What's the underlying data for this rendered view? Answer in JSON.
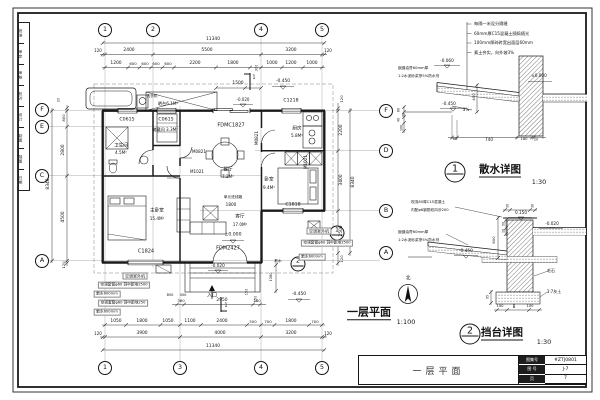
{
  "sheet": {
    "signature_strip": {
      "cells": [
        "批准",
        "审定",
        "审核",
        "校对",
        "设计",
        "制图",
        "描图",
        "日期"
      ]
    },
    "title_block": {
      "drawing_title": "一层平面",
      "fields": [
        {
          "label": "图集号",
          "value": "#ZTJ0801"
        },
        {
          "label": "图 号",
          "value": "J-7"
        },
        {
          "label": "页",
          "value": "7"
        }
      ]
    }
  },
  "plan": {
    "title": "一层平面",
    "scale": "1:100",
    "north_label": "北",
    "overall_dimensions": {
      "width": "11340",
      "height": "8340"
    },
    "grid_axes": {
      "horizontal": [
        "1",
        "2",
        "3",
        "4",
        "5"
      ],
      "vertical": [
        "A",
        "B",
        "C",
        "D",
        "E",
        "F"
      ]
    },
    "rooms": [
      {
        "name": "卫生间",
        "area": "4.5M²"
      },
      {
        "name": "储藏间",
        "area": "3.3M²"
      },
      {
        "name": "餐厅",
        "area": "7.2M²"
      },
      {
        "name": "厨房",
        "area": "5.8M²"
      },
      {
        "name": "主卧室",
        "area": "15.4M²"
      },
      {
        "name": "客厅",
        "area": "17.0M²"
      },
      {
        "name": "卧室",
        "area": "9.4M²"
      },
      {
        "name": "晒台",
        "area": "6.1M²"
      }
    ],
    "openings": [
      "C0615",
      "C1218",
      "C1818",
      "C1824",
      "FDMC1827",
      "FDM2427",
      "M0821",
      "M1021"
    ],
    "levels": [
      "±0.000",
      "-0.020",
      "-0.450"
    ]
  },
  "details": [
    {
      "number": "1",
      "title": "散水详图",
      "scale": "1:30"
    },
    {
      "number": "2",
      "title": "挡台详图",
      "scale": "1:30"
    }
  ],
  "bubbles": [
    {
      "x": 105,
      "y": 30,
      "t": "1",
      "k": "g"
    },
    {
      "x": 153,
      "y": 30,
      "t": "2",
      "k": "g"
    },
    {
      "x": 261,
      "y": 30,
      "t": "4",
      "k": "g"
    },
    {
      "x": 322,
      "y": 30,
      "t": "5",
      "k": "g"
    },
    {
      "x": 105,
      "y": 368,
      "t": "1",
      "k": "g"
    },
    {
      "x": 180,
      "y": 368,
      "t": "3",
      "k": "g"
    },
    {
      "x": 261,
      "y": 368,
      "t": "4",
      "k": "g"
    },
    {
      "x": 322,
      "y": 368,
      "t": "5",
      "k": "g"
    },
    {
      "x": 42,
      "y": 110,
      "t": "F",
      "k": "g"
    },
    {
      "x": 42,
      "y": 127,
      "t": "E",
      "k": "g"
    },
    {
      "x": 42,
      "y": 176,
      "t": "C",
      "k": "g"
    },
    {
      "x": 42,
      "y": 261,
      "t": "A",
      "k": "g"
    },
    {
      "x": 386,
      "y": 111,
      "t": "F",
      "k": "g"
    },
    {
      "x": 386,
      "y": 151,
      "t": "D",
      "k": "g"
    },
    {
      "x": 386,
      "y": 211,
      "t": "B",
      "k": "g"
    },
    {
      "x": 386,
      "y": 253,
      "t": "A",
      "k": "g"
    },
    {
      "x": 337,
      "y": 233,
      "t": "1",
      "k": "s"
    },
    {
      "x": 298,
      "y": 264,
      "t": "2",
      "k": "s"
    },
    {
      "x": 455,
      "y": 172,
      "t": "1",
      "k": "d"
    },
    {
      "x": 470,
      "y": 334,
      "t": "2",
      "k": "d"
    }
  ],
  "labels": [
    {
      "t": "11340",
      "x": 213,
      "y": 40
    },
    {
      "t": "120",
      "x": 98,
      "y": 51,
      "s": 4
    },
    {
      "t": "2400",
      "x": 129,
      "y": 51
    },
    {
      "t": "5500",
      "x": 207,
      "y": 51
    },
    {
      "t": "3200",
      "x": 291,
      "y": 51
    },
    {
      "t": "120",
      "x": 328,
      "y": 51,
      "s": 4
    },
    {
      "t": "1200",
      "x": 116,
      "y": 64
    },
    {
      "t": "600",
      "x": 133,
      "y": 64,
      "s": 3.8
    },
    {
      "t": "600",
      "x": 145,
      "y": 64,
      "s": 3.8
    },
    {
      "t": "600",
      "x": 156,
      "y": 64,
      "s": 3.8
    },
    {
      "t": "600",
      "x": 168,
      "y": 64,
      "s": 3.8
    },
    {
      "t": "2200",
      "x": 195,
      "y": 64
    },
    {
      "t": "1800",
      "x": 233,
      "y": 64
    },
    {
      "t": "300",
      "x": 257,
      "y": 68,
      "s": 3.4,
      "r": -90
    },
    {
      "t": "1000",
      "x": 272,
      "y": 64
    },
    {
      "t": "1200",
      "x": 291,
      "y": 64
    },
    {
      "t": "1000",
      "x": 312,
      "y": 64
    },
    {
      "t": "1500",
      "x": 238,
      "y": 84
    },
    {
      "t": "-0.450",
      "x": 283,
      "y": 82,
      "c": "v"
    },
    {
      "t": "-0.020",
      "x": 243,
      "y": 100,
      "s": 4,
      "c": "v"
    },
    {
      "t": "1",
      "x": 254,
      "y": 78,
      "s": 5
    },
    {
      "t": "8340",
      "x": 49,
      "y": 184,
      "r": -90
    },
    {
      "t": "20",
      "x": 59,
      "y": 100,
      "r": -90,
      "s": 3.4
    },
    {
      "t": "800",
      "x": 64,
      "y": 118,
      "r": -90,
      "s": 3.8
    },
    {
      "t": "2800",
      "x": 64,
      "y": 150,
      "r": -90
    },
    {
      "t": "4500",
      "x": 64,
      "y": 217,
      "r": -90
    },
    {
      "t": "120",
      "x": 64,
      "y": 265,
      "r": -90,
      "s": 3.8
    },
    {
      "t": "8340",
      "x": 354,
      "y": 182,
      "r": -90
    },
    {
      "t": "120",
      "x": 342,
      "y": 99,
      "r": -90,
      "s": 3.8
    },
    {
      "t": "2200",
      "x": 342,
      "y": 130,
      "r": -90
    },
    {
      "t": "3400",
      "x": 342,
      "y": 180,
      "r": -90
    },
    {
      "t": "2500",
      "x": 342,
      "y": 231,
      "r": -90
    },
    {
      "t": "120",
      "x": 342,
      "y": 259,
      "r": -90,
      "s": 3.8
    },
    {
      "t": "360",
      "x": 181,
      "y": 301,
      "s": 3.8
    },
    {
      "t": "2950",
      "x": 222,
      "y": 301
    },
    {
      "t": "360",
      "x": 257,
      "y": 301,
      "s": 3.8
    },
    {
      "t": "150",
      "x": 247,
      "y": 292,
      "s": 3.4,
      "r": -90
    },
    {
      "t": "150",
      "x": 256,
      "y": 299,
      "s": 3.4,
      "r": -90
    },
    {
      "t": "1050",
      "x": 116,
      "y": 322
    },
    {
      "t": "1800",
      "x": 142,
      "y": 322
    },
    {
      "t": "1050",
      "x": 168,
      "y": 322
    },
    {
      "t": "1100",
      "x": 190,
      "y": 322
    },
    {
      "t": "2400",
      "x": 222,
      "y": 322
    },
    {
      "t": "500",
      "x": 253,
      "y": 322,
      "s": 3.8
    },
    {
      "t": "700",
      "x": 268,
      "y": 322,
      "s": 3.8
    },
    {
      "t": "1800",
      "x": 291,
      "y": 322
    },
    {
      "t": "700",
      "x": 315,
      "y": 322,
      "s": 3.8
    },
    {
      "t": "120",
      "x": 98,
      "y": 334,
      "s": 4
    },
    {
      "t": "3900",
      "x": 142,
      "y": 334
    },
    {
      "t": "4000",
      "x": 220,
      "y": 334
    },
    {
      "t": "3200",
      "x": 291,
      "y": 334
    },
    {
      "t": "120",
      "x": 328,
      "y": 334,
      "s": 4
    },
    {
      "t": "11340",
      "x": 213,
      "y": 347
    },
    {
      "t": "1",
      "x": 226,
      "y": 306,
      "s": 5
    },
    {
      "t": "入口",
      "x": 212,
      "y": 296,
      "s": 5,
      "c": "n"
    },
    {
      "t": "-0.450",
      "x": 299,
      "y": 295,
      "c": "v"
    },
    {
      "t": "850",
      "x": 170,
      "y": 296,
      "s": 3.6
    },
    {
      "t": "450",
      "x": 183,
      "y": 296,
      "s": 3.6
    },
    {
      "t": "1360",
      "x": 272,
      "y": 277,
      "r": -90,
      "s": 3.6
    },
    {
      "t": "空调室外机",
      "x": 135,
      "y": 276,
      "s": 4,
      "bg": 1,
      "c": "n"
    },
    {
      "t": "空调套管φ60 洞中距地2500",
      "x": 124,
      "y": 285,
      "s": 3.7,
      "bg": 1,
      "c": "n"
    },
    {
      "t": "散水600mm",
      "x": 107,
      "y": 294,
      "s": 3.7,
      "bg": 1,
      "c": "n"
    },
    {
      "t": "空调套管φ60 洞中距地250",
      "x": 123,
      "y": 303,
      "s": 3.7,
      "bg": 1,
      "c": "n"
    },
    {
      "t": "散水600mm",
      "x": 107,
      "y": 312,
      "s": 3.7,
      "bg": 1,
      "c": "n"
    },
    {
      "t": "空调室外机",
      "x": 319,
      "y": 231,
      "s": 4,
      "bg": 1,
      "c": "n"
    },
    {
      "t": "空调套管φ60 洞中距地2500",
      "x": 327,
      "y": 243,
      "s": 3.7,
      "bg": 1,
      "c": "n"
    },
    {
      "t": "散水600mm",
      "x": 312,
      "y": 257,
      "s": 3.7,
      "bg": 1,
      "c": "n"
    },
    {
      "t": "散水",
      "x": 278,
      "y": 262,
      "s": 3.7,
      "c": "n"
    },
    {
      "t": "卫生间",
      "x": 121,
      "y": 147,
      "s": 4.6,
      "c": "r"
    },
    {
      "t": "4.5M²",
      "x": 121,
      "y": 153,
      "s": 4.2,
      "c": "r"
    },
    {
      "t": "储藏间 3.3M²",
      "x": 165,
      "y": 130,
      "s": 4.2,
      "c": "r"
    },
    {
      "t": "餐厅",
      "x": 228,
      "y": 171,
      "s": 4.6,
      "c": "r"
    },
    {
      "t": "7.2M²",
      "x": 228,
      "y": 177,
      "s": 4.2,
      "c": "r"
    },
    {
      "t": "厨房",
      "x": 297,
      "y": 130,
      "s": 4.6,
      "c": "r"
    },
    {
      "t": "5.8M²",
      "x": 297,
      "y": 136,
      "s": 4.2,
      "c": "r"
    },
    {
      "t": "主卧室",
      "x": 157,
      "y": 212,
      "s": 4.6,
      "c": "r"
    },
    {
      "t": "15.4M²",
      "x": 157,
      "y": 219,
      "s": 4.2,
      "c": "r"
    },
    {
      "t": "客厅",
      "x": 240,
      "y": 218,
      "s": 4.6,
      "c": "r"
    },
    {
      "t": "17.0M²",
      "x": 240,
      "y": 225,
      "s": 4.2,
      "c": "r"
    },
    {
      "t": "卧室",
      "x": 269,
      "y": 181,
      "s": 4.6,
      "c": "r"
    },
    {
      "t": "9.4M²",
      "x": 269,
      "y": 188,
      "s": 4.2,
      "c": "r"
    },
    {
      "t": "晒台6.1M²",
      "x": 168,
      "y": 104,
      "s": 4.2,
      "c": "r"
    },
    {
      "t": "洗衣机",
      "x": 152,
      "y": 97,
      "s": 3.7,
      "c": "n"
    },
    {
      "t": "C0615",
      "x": 127,
      "y": 121,
      "s": 4.7,
      "c": "o"
    },
    {
      "t": "C0615",
      "x": 166,
      "y": 121,
      "s": 4.7,
      "c": "o"
    },
    {
      "t": "FDMC1827",
      "x": 231,
      "y": 126,
      "s": 5,
      "c": "o"
    },
    {
      "t": "C1218",
      "x": 291,
      "y": 102,
      "s": 4.7,
      "c": "o"
    },
    {
      "t": "C1824",
      "x": 146,
      "y": 252,
      "s": 5,
      "c": "o"
    },
    {
      "t": "FDM2427",
      "x": 228,
      "y": 249,
      "s": 5,
      "c": "o"
    },
    {
      "t": "C1818",
      "x": 293,
      "y": 206,
      "s": 4.7,
      "c": "o"
    },
    {
      "t": "M0821",
      "x": 199,
      "y": 152,
      "s": 4.1,
      "c": "o"
    },
    {
      "t": "M1021",
      "x": 197,
      "y": 172,
      "s": 4.1,
      "c": "o"
    },
    {
      "t": "M1021",
      "x": 306,
      "y": 162,
      "r": -90,
      "s": 4.1,
      "c": "o"
    },
    {
      "t": "M0821",
      "x": 257,
      "y": 138,
      "r": -90,
      "s": 4.1,
      "c": "o"
    },
    {
      "t": "±0.000",
      "x": 233,
      "y": 236,
      "s": 4.6,
      "c": "v"
    },
    {
      "t": "-0.020",
      "x": 218,
      "y": 266,
      "s": 4.2,
      "c": "v"
    },
    {
      "t": "单元进线箱",
      "x": 233,
      "y": 198,
      "s": 3.7,
      "c": "n"
    },
    {
      "t": "1800",
      "x": 231,
      "y": 205,
      "s": 4.2
    },
    {
      "t": "一层平面",
      "x": 369,
      "y": 313,
      "s": 11,
      "w": 1,
      "u": 1,
      "c": "t"
    },
    {
      "t": "1:100",
      "x": 406,
      "y": 322,
      "s": 6.5,
      "c": "t"
    },
    {
      "t": "北",
      "x": 408,
      "y": 279,
      "s": 5,
      "c": "t"
    },
    {
      "t": "每隔一米设分隔缝",
      "x": 474,
      "y": 24,
      "s": 4.2,
      "a": "l",
      "c": "n"
    },
    {
      "t": "60mm厚C15混凝土随捣随光",
      "x": 474,
      "y": 33.5,
      "s": 4.2,
      "a": "l",
      "c": "n"
    },
    {
      "t": "100mm厚碎砖宽出面层60mm",
      "x": 474,
      "y": 43,
      "s": 4.2,
      "a": "l",
      "c": "n"
    },
    {
      "t": "素土夯实，向外坡3%",
      "x": 474,
      "y": 52.5,
      "s": 4.2,
      "a": "l",
      "c": "n"
    },
    {
      "t": "嵌缝油膏60mm厚",
      "x": 398,
      "y": 69,
      "s": 3.7,
      "a": "l",
      "c": "n"
    },
    {
      "t": "1:2水泥砂浆掺5%防水剂",
      "x": 398,
      "y": 77,
      "s": 3.7,
      "a": "l",
      "c": "n"
    },
    {
      "t": "-0.060",
      "x": 447,
      "y": 61,
      "s": 4.2,
      "c": "v"
    },
    {
      "t": "±0.000",
      "x": 539,
      "y": 76,
      "s": 4.2,
      "c": "v"
    },
    {
      "t": "-0.450",
      "x": 449,
      "y": 104,
      "s": 4.2,
      "c": "v"
    },
    {
      "t": "3%",
      "x": 466,
      "y": 110,
      "s": 4.2
    },
    {
      "t": "400",
      "x": 474,
      "y": 97,
      "r": -90,
      "s": 3.8
    },
    {
      "t": "60",
      "x": 399,
      "y": 110,
      "r": -90,
      "s": 3.2
    },
    {
      "t": "20",
      "x": 404,
      "y": 114.5,
      "r": -90,
      "s": 3.2
    },
    {
      "t": "40",
      "x": 399,
      "y": 120,
      "r": -90,
      "s": 3.2
    },
    {
      "t": "100",
      "x": 402,
      "y": 127.5,
      "r": -90,
      "s": 3.2
    },
    {
      "t": "60",
      "x": 455,
      "y": 140,
      "s": 3.7
    },
    {
      "t": "740",
      "x": 489,
      "y": 140,
      "s": 4.2
    },
    {
      "t": "180",
      "x": 524,
      "y": 140,
      "s": 3.7
    },
    {
      "t": "20",
      "x": 536,
      "y": 140,
      "s": 3.4
    },
    {
      "t": "散水详图",
      "x": 500,
      "y": 171,
      "s": 10.5,
      "w": 1,
      "u": 1,
      "c": "t"
    },
    {
      "t": "1:30",
      "x": 539,
      "y": 182,
      "s": 6.5,
      "c": "t"
    },
    {
      "t": "现浇80厚C15混凝土",
      "x": 411,
      "y": 203,
      "s": 3.7,
      "a": "l",
      "c": "n"
    },
    {
      "t": "内配φ6钢筋双向@200",
      "x": 411,
      "y": 210.5,
      "s": 3.7,
      "a": "l",
      "c": "n"
    },
    {
      "t": "30",
      "x": 507.5,
      "y": 206,
      "r": -90,
      "s": 3.2
    },
    {
      "t": "30",
      "x": 532.5,
      "y": 206,
      "r": -90,
      "s": 3.2
    },
    {
      "t": "0.150",
      "x": 521,
      "y": 213,
      "s": 4.2,
      "c": "v"
    },
    {
      "t": "-0.020",
      "x": 552,
      "y": 224,
      "s": 4.2,
      "c": "v"
    },
    {
      "t": "嵌缝油膏60mm厚",
      "x": 398,
      "y": 233,
      "s": 3.7,
      "a": "l",
      "c": "n"
    },
    {
      "t": "1:2水泥砂浆掺5%防水剂",
      "x": 398,
      "y": 241,
      "s": 3.7,
      "a": "l",
      "c": "n"
    },
    {
      "t": "-0.450",
      "x": 466,
      "y": 251,
      "s": 4.2,
      "c": "v"
    },
    {
      "t": "600",
      "x": 494,
      "y": 240,
      "r": -90,
      "s": 3.8
    },
    {
      "t": "50",
      "x": 503.5,
      "y": 224,
      "r": -90,
      "s": 3.2
    },
    {
      "t": "10",
      "x": 503.5,
      "y": 231,
      "r": -90,
      "s": 3.2
    },
    {
      "t": "毛石",
      "x": 551,
      "y": 271,
      "s": 4,
      "c": "n"
    },
    {
      "t": "3:7灰土",
      "x": 554,
      "y": 292,
      "s": 4,
      "c": "n"
    },
    {
      "t": "95",
      "x": 488,
      "y": 297,
      "r": -90,
      "s": 3.2
    },
    {
      "t": "100",
      "x": 500,
      "y": 307,
      "s": 3.7
    },
    {
      "t": "B",
      "x": 514,
      "y": 307,
      "s": 4
    },
    {
      "t": "100",
      "x": 530,
      "y": 307,
      "s": 3.7
    },
    {
      "t": "挡台详图",
      "x": 502,
      "y": 334,
      "s": 10.5,
      "w": 1,
      "u": 1,
      "c": "t"
    },
    {
      "t": "1:30",
      "x": 544,
      "y": 342,
      "s": 6.5,
      "c": "t"
    }
  ]
}
